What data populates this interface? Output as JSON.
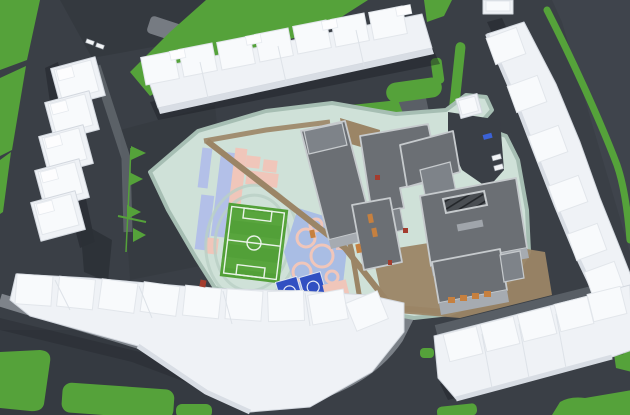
{
  "scene": {
    "name": "aerial-3d-site-plan",
    "description": "Isometric aerial 3D render of an urban residential block: white apartment rows around a perimeter courtyard containing a school campus with soccer field, running-track lanes, basketball courts, playground, pathways, lawns and surrounding roads",
    "features": [
      "roads",
      "lawns",
      "residential-building-rows",
      "school-buildings",
      "soccer-field",
      "track-lanes",
      "basketball-courts",
      "playground",
      "pathways",
      "parking-islands",
      "cars",
      "tree-markers"
    ]
  },
  "palette": {
    "road": "#3a3f46",
    "road_dark": "#30343a",
    "road_light": "#41464d",
    "sidewalk": "#82878e",
    "sidewalk_dark": "#6d7379",
    "grass": "#55a23a",
    "grass_dark": "#4e9434",
    "building_face": "#eff2f6",
    "building_roof": "#f8fafc",
    "building_side": "#d8dde4",
    "building_line": "#dde2e8",
    "campus_ground": "#cfe1d8",
    "campus_edge": "#a6beb3",
    "track_lavender": "#b3c0e8",
    "playground_blue": "#a9bde4",
    "track_pink": "#f0c6ba",
    "field_green": "#52a038",
    "field_light": "#5caa42",
    "field_line": "#e9f3e8",
    "oval_line": "#b9d0c5",
    "court_blue": "#3150c2",
    "court_blue_dark": "#2438a0",
    "path_tan": "#9b8566",
    "school_roof": "#6b6f74",
    "school_roof_light": "#7e8389",
    "school_parapet": "#c6cacd",
    "school_wall": "#a6abb1",
    "accent_orange": "#c6803f",
    "accent_red": "#a43c2e",
    "shadow": "#1c2025",
    "car_white": "#f2f4f6",
    "car_blue": "#3b62d6"
  }
}
